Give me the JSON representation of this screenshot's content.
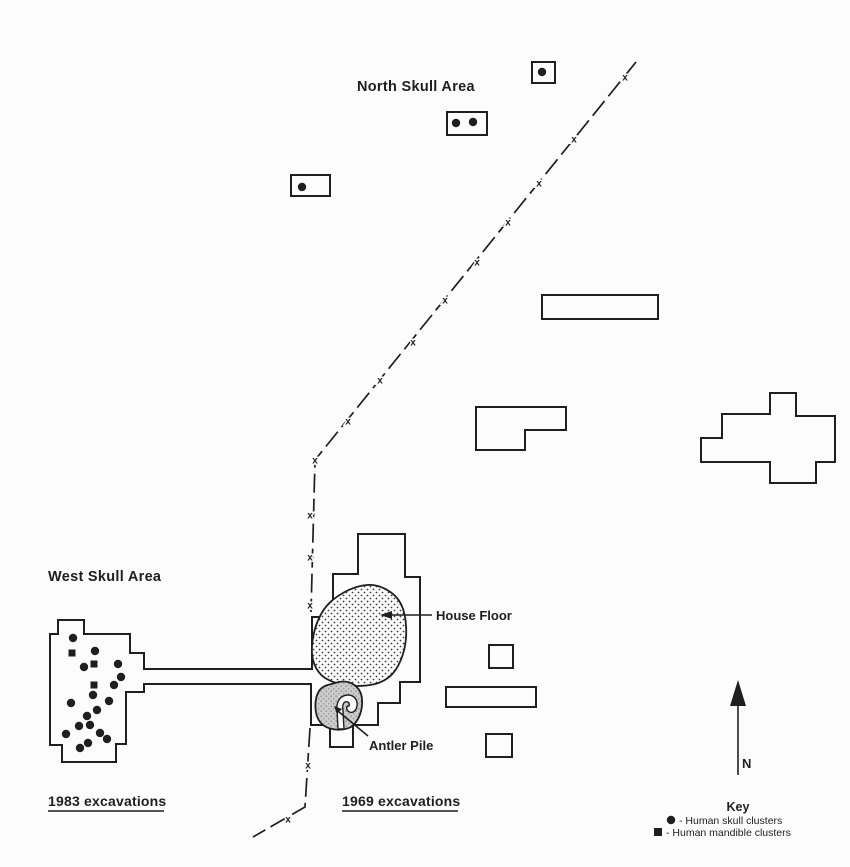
{
  "colors": {
    "ink": "#1f1f1f",
    "background": "#fcfcfc",
    "antler_fill": "#cccccc"
  },
  "labels": {
    "north_skull_area": "North Skull Area",
    "west_skull_area": "West Skull Area",
    "house_floor": "House Floor",
    "antler_pile": "Antler Pile",
    "excavations_1983": "1983 excavations",
    "excavations_1969": "1969 excavations",
    "north_indicator": "N"
  },
  "key": {
    "title": "Key",
    "entries": [
      {
        "symbol": "●",
        "label": "- Human skull clusters"
      },
      {
        "symbol": "■",
        "label": "- Human mandible clusters"
      }
    ]
  },
  "north_skull_area": {
    "units": [
      {
        "x": 532,
        "y": 62,
        "w": 23,
        "h": 21,
        "dots": [
          [
            542,
            72
          ]
        ]
      },
      {
        "x": 447,
        "y": 112,
        "w": 40,
        "h": 23,
        "dots": [
          [
            456,
            123
          ],
          [
            473,
            122
          ]
        ]
      },
      {
        "x": 291,
        "y": 175,
        "w": 39,
        "h": 21,
        "dots": [
          [
            302,
            187
          ]
        ]
      }
    ]
  },
  "west_skull_area": {
    "skull_points": [
      [
        73,
        638
      ],
      [
        95,
        651
      ],
      [
        84,
        667
      ],
      [
        118,
        664
      ],
      [
        121,
        677
      ],
      [
        114,
        685
      ],
      [
        93,
        695
      ],
      [
        109,
        701
      ],
      [
        71,
        703
      ],
      [
        97,
        710
      ],
      [
        87,
        716
      ],
      [
        90,
        725
      ],
      [
        79,
        726
      ],
      [
        100,
        733
      ],
      [
        66,
        734
      ],
      [
        107,
        739
      ],
      [
        88,
        743
      ],
      [
        80,
        748
      ]
    ],
    "mandible_points": [
      [
        72,
        653
      ],
      [
        94,
        664
      ],
      [
        94,
        685
      ]
    ]
  },
  "survey_line": {
    "mark_char": "x",
    "marks": [
      [
        625,
        77
      ],
      [
        574,
        139
      ],
      [
        539,
        183
      ],
      [
        508,
        222
      ],
      [
        477,
        262
      ],
      [
        445,
        300
      ],
      [
        413,
        342
      ],
      [
        380,
        380
      ],
      [
        348,
        421
      ],
      [
        315,
        460
      ],
      [
        310,
        515
      ],
      [
        310,
        557
      ],
      [
        310,
        605
      ],
      [
        308,
        765
      ],
      [
        288,
        819
      ]
    ]
  }
}
